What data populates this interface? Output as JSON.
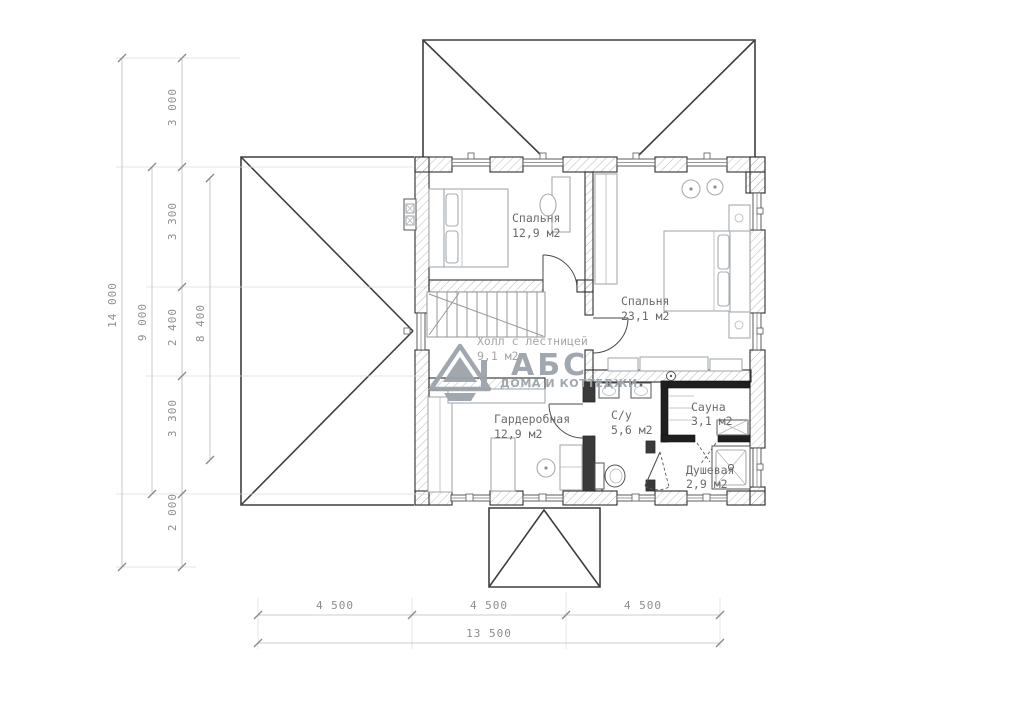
{
  "rooms": [
    {
      "name": "Спальня",
      "area": "12,9 м2"
    },
    {
      "name": "Спальня",
      "area": "23,1 м2"
    },
    {
      "name": "Холл с лестницей",
      "area": "9,1 м2"
    },
    {
      "name": "Гардеробная",
      "area": "12,9 м2"
    },
    {
      "name": "С/у",
      "area": "5,6 м2"
    },
    {
      "name": "Сауна",
      "area": "3,1 м2"
    },
    {
      "name": "Душевая",
      "area": "2,9 м2"
    }
  ],
  "dimensions": {
    "left_chain": [
      "3 000",
      "3 300",
      "2 400",
      "3 300",
      "2 000"
    ],
    "left_overall": "14 000",
    "left_span": "9 000",
    "left_inner": "8 400",
    "bottom_chain": [
      "4 500",
      "4 500",
      "4 500"
    ],
    "bottom_overall": "13 500"
  },
  "logo": {
    "brand": "АБС",
    "tagline": "ДОМА И КОТТЕДЖИ"
  },
  "colors": {
    "logo": "#9ba3ab",
    "linework": "#3c3c3c",
    "dimension_text": "#8d8d8d"
  }
}
